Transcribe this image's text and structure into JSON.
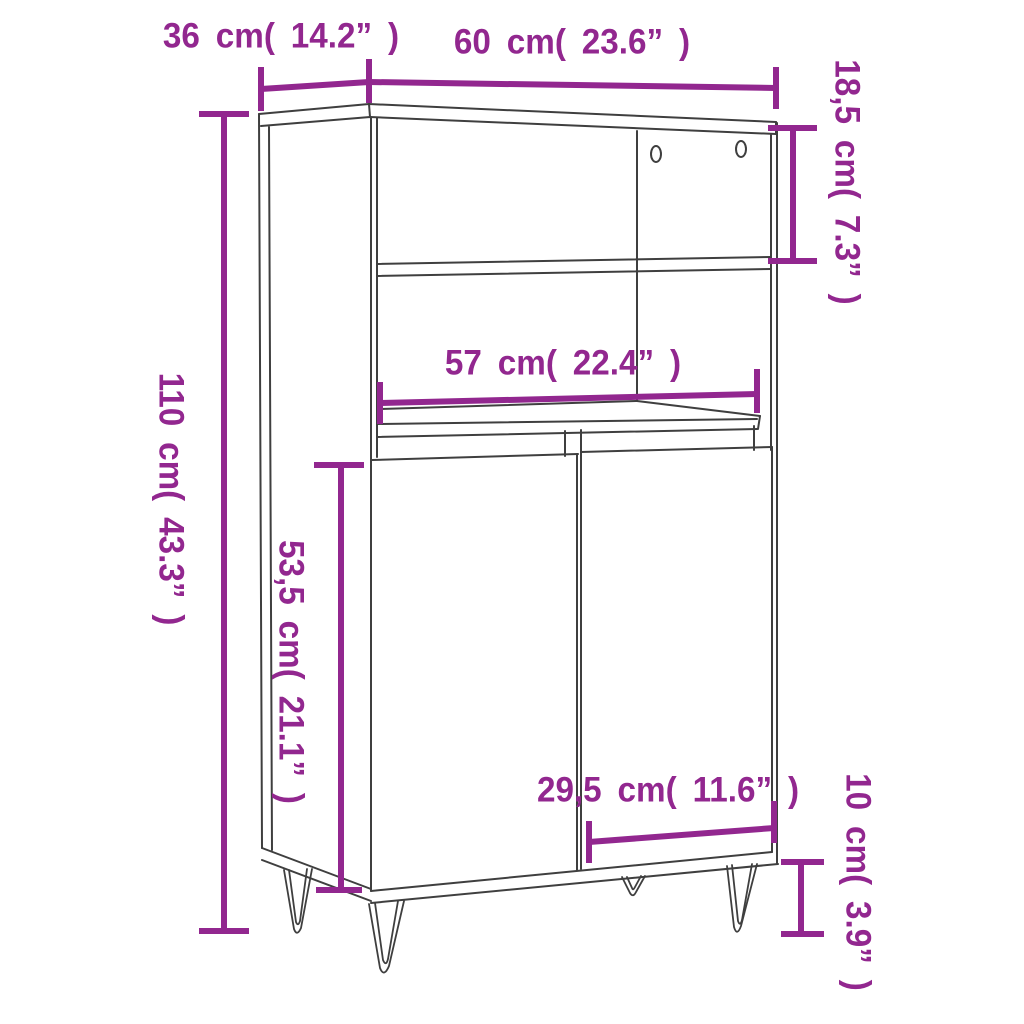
{
  "diagram": {
    "type": "furniture-dimension-diagram",
    "subject": "highboard cabinet with two open shelves, two doors and hairpin legs",
    "background_color": "#ffffff",
    "accent_color": "#92278F",
    "line_color": "#3f3f3f",
    "labels": {
      "depth": {
        "text": "36 cm( 14.2” )",
        "cm": "36",
        "inches": "14.2",
        "orientation": "horizontal",
        "measures": "cabinet depth (top left)"
      },
      "width": {
        "text": "60 cm( 23.6” )",
        "cm": "60",
        "inches": "23.6",
        "orientation": "horizontal",
        "measures": "overall width (top)"
      },
      "top_compartment_height": {
        "text": "18,5 cm( 7.3” )",
        "cm": "18,5",
        "inches": "7.3",
        "orientation": "vertical",
        "measures": "open compartment height (right)"
      },
      "total_height": {
        "text": "110 cm( 43.3” )",
        "cm": "110",
        "inches": "43.3",
        "orientation": "vertical",
        "measures": "total height (left)"
      },
      "inner_width": {
        "text": "57 cm( 22.4” )",
        "cm": "57",
        "inches": "22.4",
        "orientation": "horizontal",
        "measures": "inner shelf width (middle)"
      },
      "door_height": {
        "text": "53,5 cm( 21.1” )",
        "cm": "53,5",
        "inches": "21.1",
        "orientation": "vertical",
        "measures": "door height (left of doors)"
      },
      "door_width": {
        "text": "29,5 cm( 11.6” )",
        "cm": "29,5",
        "inches": "11.6",
        "orientation": "horizontal",
        "measures": "door width (bottom)"
      },
      "leg_height": {
        "text": "10 cm( 3.9” )",
        "cm": "10",
        "inches": "3.9",
        "orientation": "vertical",
        "measures": "leg height (bottom right)"
      }
    }
  }
}
